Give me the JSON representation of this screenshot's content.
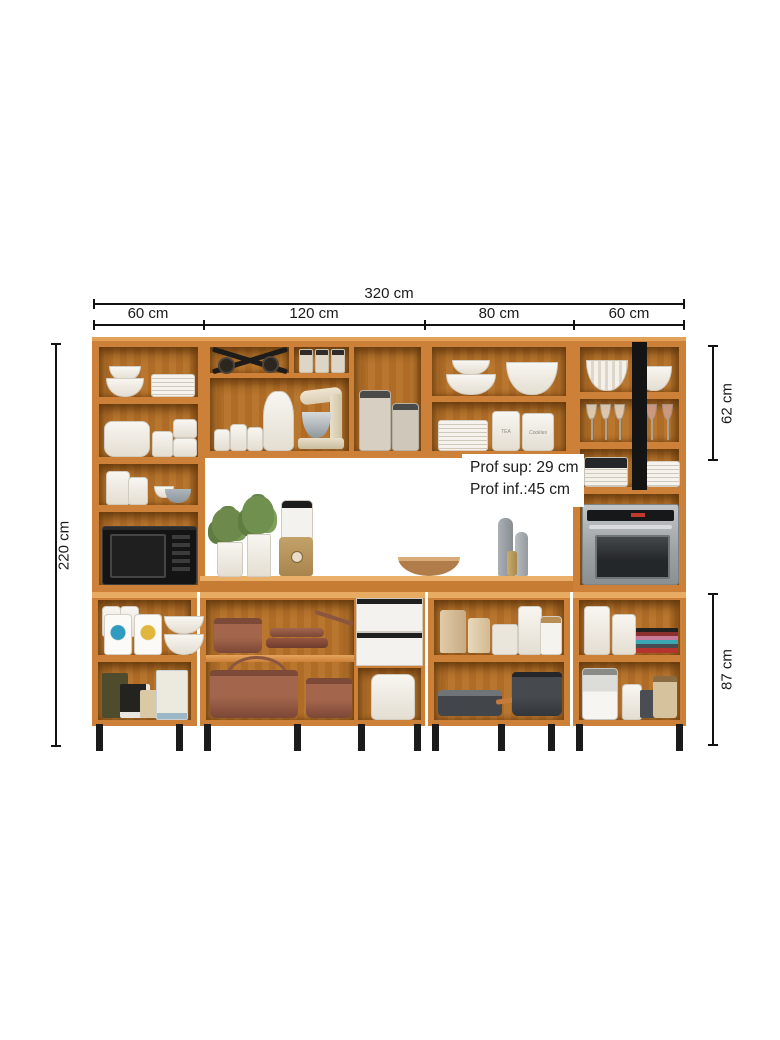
{
  "title": "Modular kitchen cabinet set — dimension diagram",
  "dimensions": {
    "total_width": "320 cm",
    "sections": [
      {
        "label": "60 cm"
      },
      {
        "label": "120 cm"
      },
      {
        "label": "80 cm"
      },
      {
        "label": "60 cm"
      }
    ],
    "total_height": "220 cm",
    "upper_cabinet_height": "62 cm",
    "base_cabinet_height": "87 cm",
    "depth_note": {
      "line1": "Prof sup: 29 cm",
      "line2": "Prof inf.:45 cm"
    }
  },
  "jar_labels": {
    "tea": "TEA",
    "cookies": "Cookies"
  },
  "palette": {
    "background": "#ffffff",
    "dimension_lines": "#121212",
    "wood_frame": "#cd8038",
    "wood_edge_light": "#e2a159",
    "wood_interior": "#b5722b",
    "appliance_black": "#141414",
    "appliance_steel": "#a7abae",
    "copper_cookware": "#9a604a",
    "white_dishes": "#f3f1ec",
    "leg_black": "#1b1b1b"
  }
}
